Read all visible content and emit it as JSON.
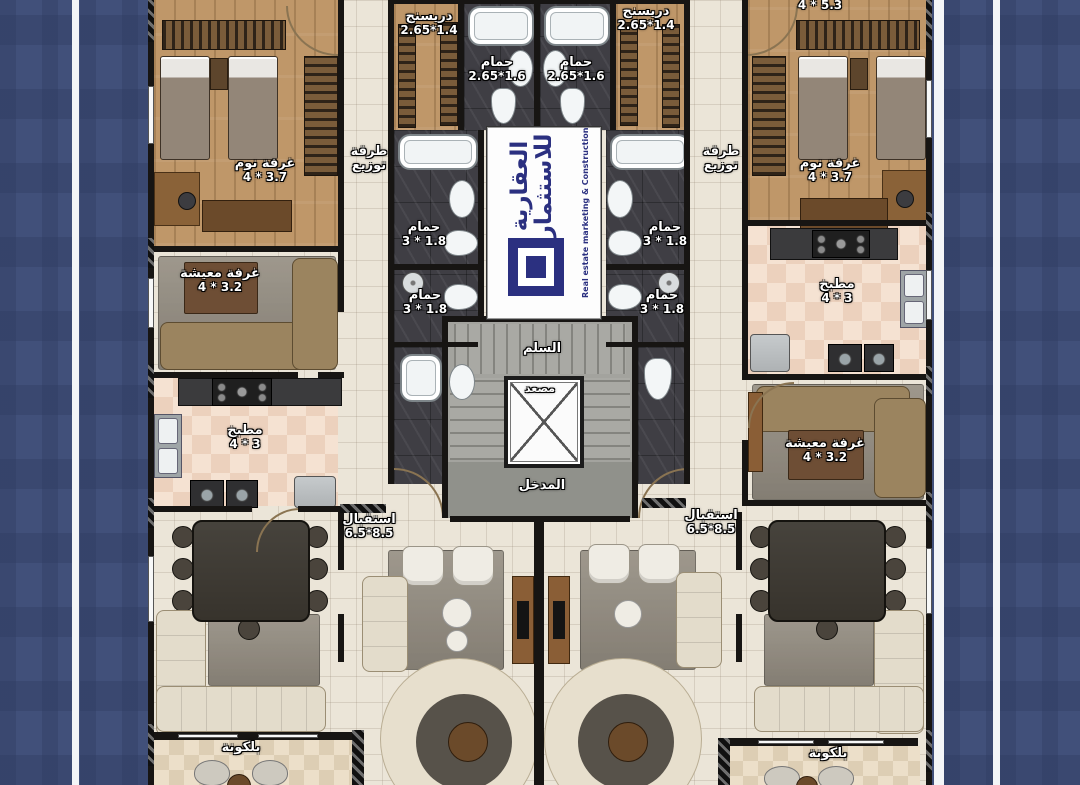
{
  "colors": {
    "background_blue": "#41507a",
    "logo_blue": "#2b3080"
  },
  "logo": {
    "brand_ar": "العقارية للاستثمار",
    "brand_en": "Real estate marketing & Construction"
  },
  "core": {
    "stairs": "السلم",
    "elevator": "مصعد",
    "entrance": "المدخل"
  },
  "labels": {
    "bedroom": "غرفة نوم",
    "bedroom_dims": "4 * 3.7",
    "top_right_dims": "4 * 5.3",
    "dressing": "دريسنج",
    "dressing_dims": "2.65*1.4",
    "bath_main": "حمام",
    "bath_main_dims": "2.65*1.6",
    "corridor_line1": "طرقة",
    "corridor_line2": "توزيع",
    "bath_small": "حمام",
    "bath_small_dims": "3 * 1.8",
    "living": "غرفة معيشة",
    "living_dims": "4 * 3.2",
    "kitchen": "مطبخ",
    "kitchen_dims": "4 * 3",
    "reception": "استقبال",
    "reception_dims": "6.5*8.5",
    "balcony": "بلكونة"
  }
}
